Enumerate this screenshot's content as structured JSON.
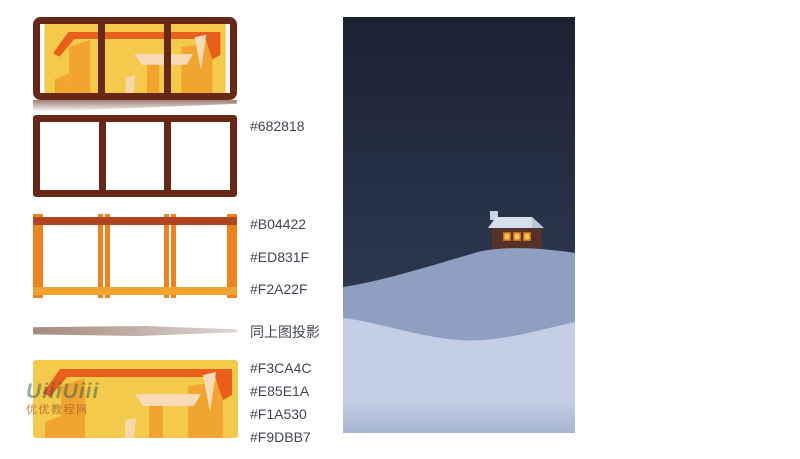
{
  "tutorial": {
    "swatch_labels": {
      "frame_color": "#682818",
      "top_bar_color": "#B04422",
      "post_color": "#ED831F",
      "bottom_bar_color": "#F2A22F",
      "shadow_note": "同上图投影",
      "scene_bg_color": "#F3CA4C",
      "scene_red_color": "#E85E1A",
      "scene_orange_color": "#F1A530",
      "scene_beige_color": "#F9DBB7"
    },
    "watermark": {
      "line1": "UiiiUiii",
      "line2": "优优教程网"
    },
    "colors": {
      "label_text": "#3f4551",
      "window_frame": "#682818",
      "structure_top_bar": "#B04422",
      "structure_posts": "#ED831F",
      "structure_bottom_bar": "#F2A22F",
      "scene_yellow": "#F3CA4C",
      "scene_red_orange": "#E85E1A",
      "scene_orange": "#F1A530",
      "scene_beige": "#F9DBB7",
      "sky_top": "#1a2232",
      "sky_bottom": "#2f3b54",
      "hill_back_top": "#8f9fc1",
      "hill_back_bottom": "#b7c1dc",
      "hill_front_top": "#c4cee6",
      "hill_front_bottom": "#a6b5d3",
      "house_body": "#543229",
      "house_roof_snow": "#d6deec",
      "house_window_lit": "#f7c54b"
    }
  }
}
